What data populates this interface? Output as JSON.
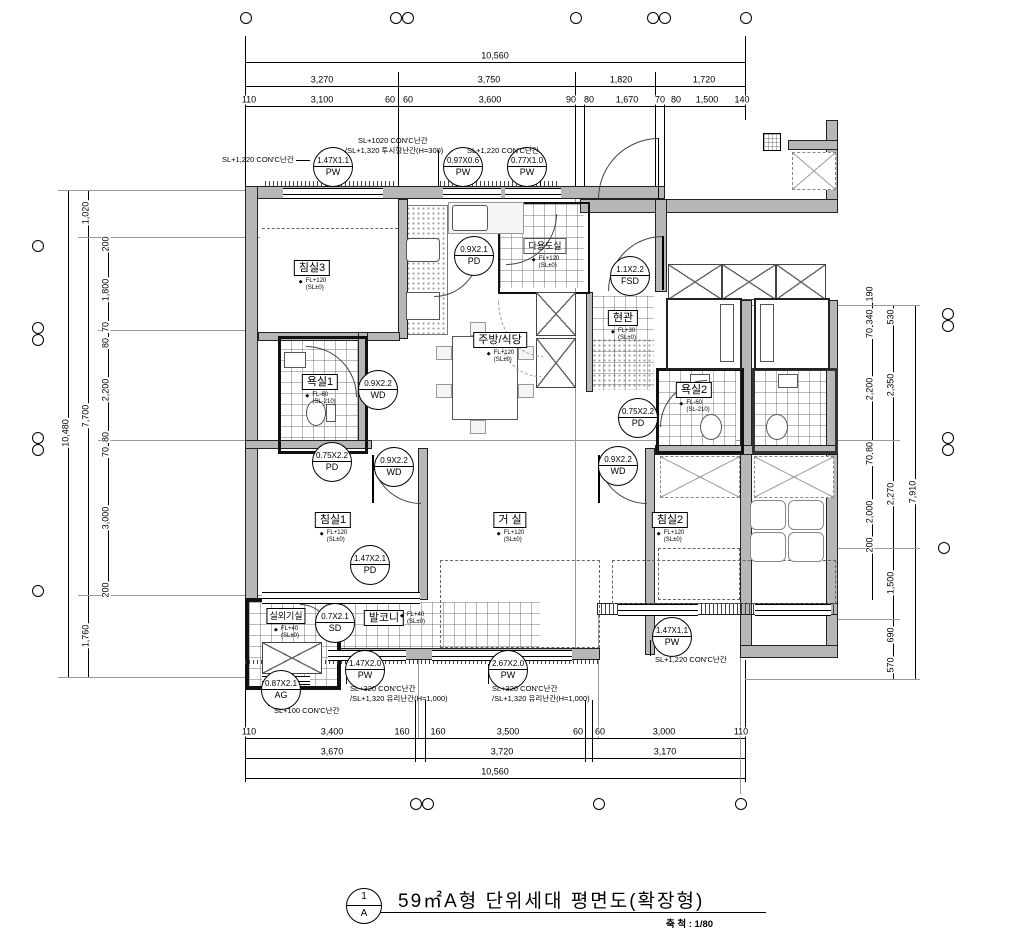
{
  "title": {
    "num": "1",
    "sheet": "A",
    "text": "59㎡A형 단위세대 평면도(확장형)",
    "scale": "축 척 : 1/80"
  },
  "dims": {
    "top": {
      "total": "10,560",
      "row2": [
        "3,270",
        "3,750",
        "1,820",
        "1,720"
      ],
      "row3": [
        "110",
        "3,100",
        "60",
        "60",
        "3,600",
        "90",
        "80",
        "1,670",
        "70",
        "80",
        "1,500",
        "140"
      ]
    },
    "bottom": {
      "row1": [
        "110",
        "3,400",
        "160",
        "160",
        "3,500",
        "60",
        "60",
        "3,000",
        "110"
      ],
      "row2": [
        "3,670",
        "3,720",
        "3,170"
      ],
      "total": "10,560"
    },
    "left": {
      "outer": "10,480",
      "mid": [
        "1,020",
        "7,700",
        "1,760"
      ],
      "inner": [
        "200",
        "1,800",
        "70",
        "80",
        "2,200",
        "80",
        "70",
        "3,000",
        "200"
      ]
    },
    "right": {
      "outer": "7,910",
      "mid": [
        "530",
        "2,350",
        "2,270",
        "1,500",
        "690",
        "570"
      ],
      "inner": [
        "190",
        "340",
        "70",
        "2,200",
        "80",
        "70",
        "2,000",
        "200"
      ]
    }
  },
  "rooms": [
    {
      "name": "침실3",
      "l1": "FL+120",
      "l2": "(SL±0)"
    },
    {
      "name": "주방/식당",
      "l1": "FL+120",
      "l2": "(SL±0)"
    },
    {
      "name": "다용도실",
      "l1": "FL+120",
      "l2": "(SL±0)"
    },
    {
      "name": "현관",
      "l1": "FL+30",
      "l2": "(SL±0)"
    },
    {
      "name": "욕실1",
      "l1": "FL-60",
      "l2": "(SL-210)"
    },
    {
      "name": "욕실2",
      "l1": "FL-60",
      "l2": "(SL-210)"
    },
    {
      "name": "침실1",
      "l1": "FL+120",
      "l2": "(SL±0)"
    },
    {
      "name": "거 실",
      "l1": "FL+120",
      "l2": "(SL±0)"
    },
    {
      "name": "침실2",
      "l1": "FL+120",
      "l2": "(SL±0)"
    },
    {
      "name": "발코니",
      "l1": "FL+40",
      "l2": "(SL±0)"
    },
    {
      "name": "실외기실",
      "l1": "FL+40",
      "l2": "(SL±0)"
    }
  ],
  "tags": [
    {
      "size": "1.47X1.1",
      "code": "PW"
    },
    {
      "size": "0.97X0.6",
      "code": "PW"
    },
    {
      "size": "0.77X1.0",
      "code": "PW"
    },
    {
      "size": "0.9X2.1",
      "code": "PD"
    },
    {
      "size": "1.1X2.2",
      "code": "FSD"
    },
    {
      "size": "0.9X2.2",
      "code": "WD"
    },
    {
      "size": "0.75X2.2",
      "code": "PD"
    },
    {
      "size": "0.9X2.2",
      "code": "WD"
    },
    {
      "size": "0.75X2.2",
      "code": "PD"
    },
    {
      "size": "0.9X2.2",
      "code": "WD"
    },
    {
      "size": "1.47X2.1",
      "code": "PD"
    },
    {
      "size": "0.7X2.1",
      "code": "SD"
    },
    {
      "size": "1.47X2.0",
      "code": "PW"
    },
    {
      "size": "2.67X2.0",
      "code": "PW"
    },
    {
      "size": "1.47X1.1",
      "code": "PW"
    },
    {
      "size": "0.87X2.1",
      "code": "AG"
    }
  ],
  "notes": {
    "t1": "SL+1,220 CON'C난간",
    "t2a": "SL+1020 CON'C난간",
    "t2b": "/SL+1,320 투시형난간(H=300)",
    "t3": "SL+1,220 CON'C난간",
    "b1a": "SL+320 CON'C난간",
    "b1b": "/SL+1,320 유리난간(H=1,000)",
    "b2a": "SL+320 CON'C난간",
    "b2b": "/SL+1,320 유리난간(H=1,000)",
    "b3": "SL+1,220 CON'C난간",
    "b4": "SL+100 CON'C난간"
  }
}
